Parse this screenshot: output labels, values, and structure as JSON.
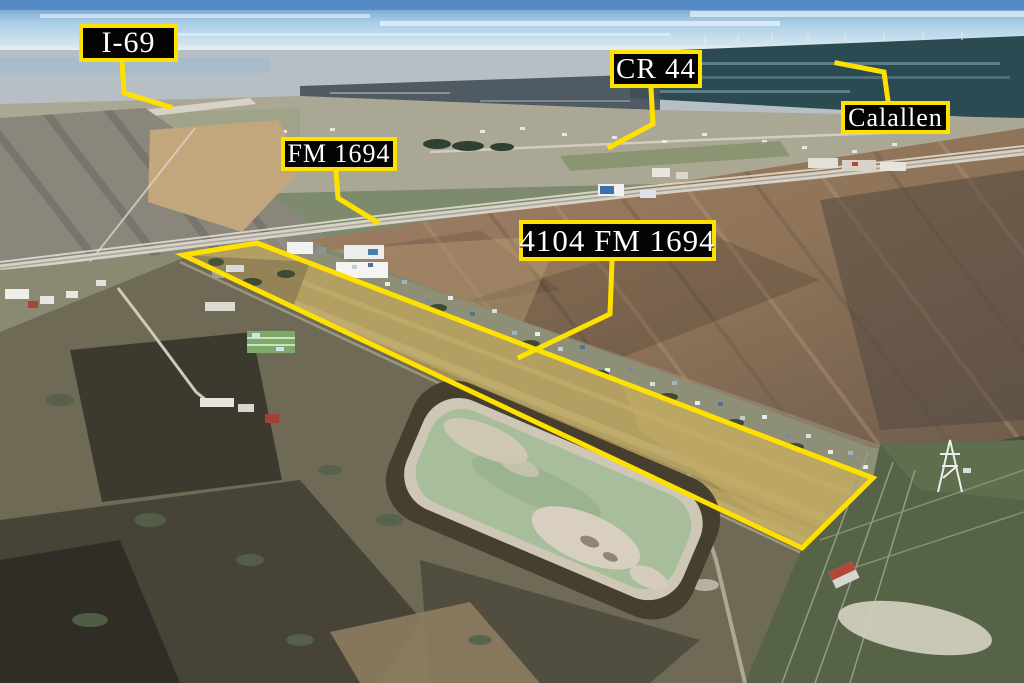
{
  "scene": {
    "description": "Aerial drone photograph of a rural Texas property for sale; long narrow parcel outlined in yellow with road and town callouts",
    "accent_color": "#ffe100",
    "label_background": "#000000",
    "label_text_color": "#ffffff"
  },
  "labels": {
    "i69": "I-69",
    "fm1694": "FM 1694",
    "address": "4104 FM 1694",
    "cr44": "CR 44",
    "calallen": "Calallen"
  }
}
